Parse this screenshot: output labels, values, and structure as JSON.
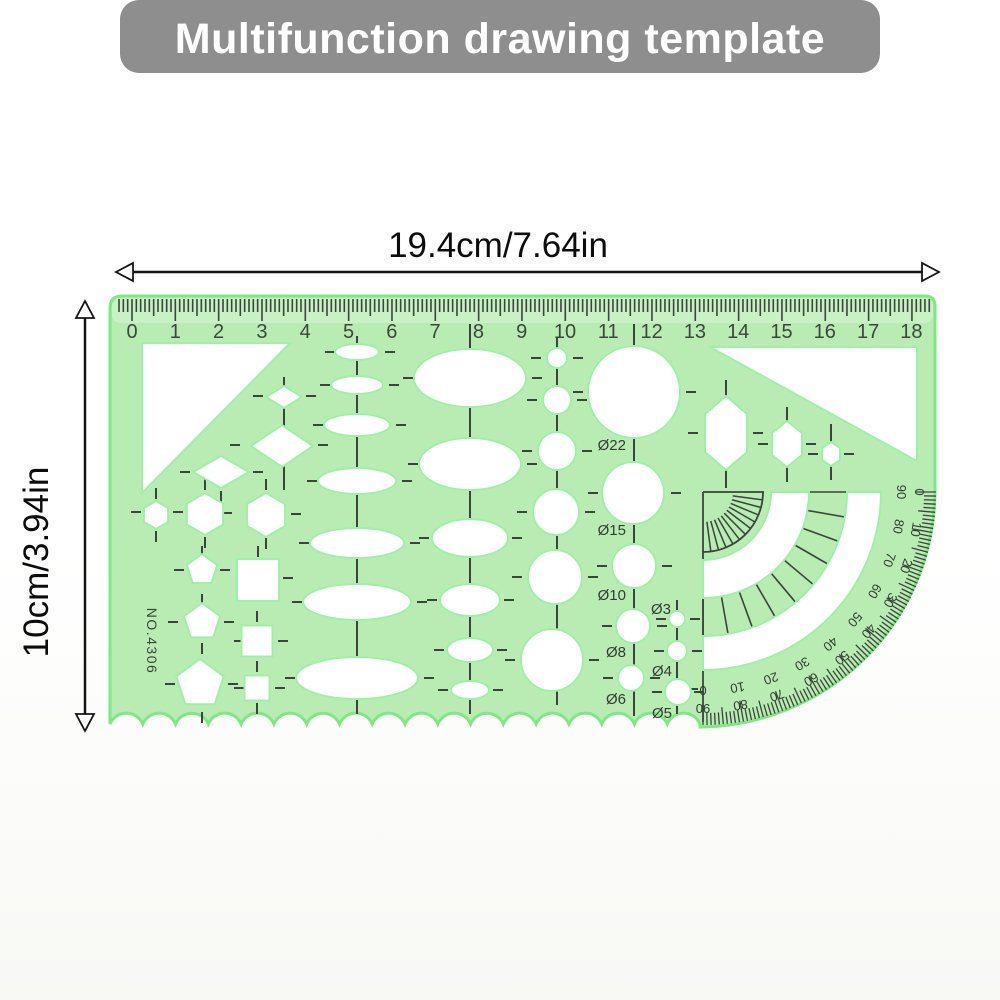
{
  "banner": {
    "title": "Multifunction drawing template",
    "bg_color": "#8e8e8e",
    "text_color": "#ffffff"
  },
  "dimension_annotations": {
    "width": "19.4cm/7.64in",
    "height": "10cm/3.94in"
  },
  "stencil": {
    "model_number": "NO.4306",
    "ruler_cm_labels": [
      "0",
      "1",
      "2",
      "3",
      "4",
      "5",
      "6",
      "7",
      "8",
      "9",
      "10",
      "11",
      "12",
      "13",
      "14",
      "15",
      "16",
      "17",
      "18"
    ],
    "diameter_labels": {
      "d22": "Ø22",
      "d15": "Ø15",
      "d10": "Ø10",
      "d8": "Ø8",
      "d6": "Ø6",
      "d3": "Ø3",
      "d4": "Ø4",
      "d5": "Ø5"
    },
    "protractor": {
      "outer_degree_labels": [
        "0",
        "10",
        "20",
        "30",
        "40",
        "50",
        "60",
        "70",
        "80",
        "90"
      ],
      "inner_degree_labels": [
        "90",
        "80",
        "70",
        "60",
        "50",
        "40",
        "30",
        "20",
        "10",
        "0"
      ]
    },
    "colors": {
      "body_green": "#b9ecb2",
      "edge_green": "#7ee885",
      "cutout_white": "#ffffff",
      "cutout_halo": "#9ff0a7",
      "marking_dark": "#3a453b"
    }
  }
}
